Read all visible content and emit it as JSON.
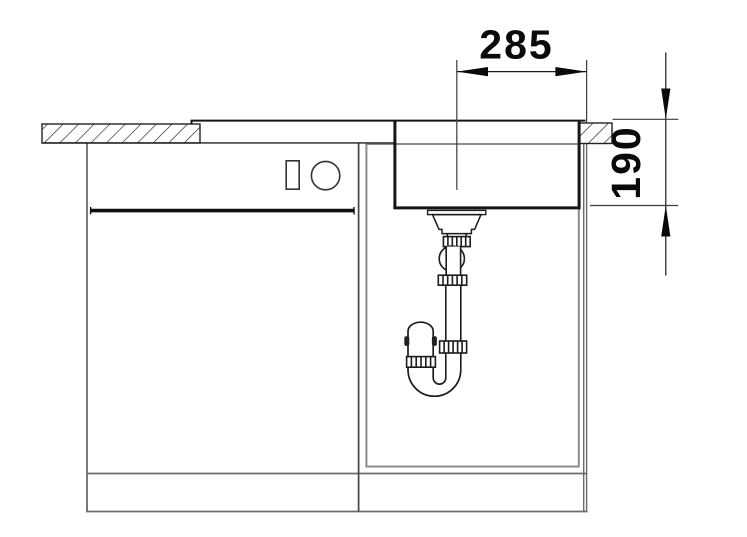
{
  "diagram": {
    "kind": "sink-installation-cross-section",
    "dimensions": {
      "width": {
        "value": "285"
      },
      "depth": {
        "value": "190"
      }
    },
    "colors": {
      "background": "#ffffff",
      "line_dark": "#1c1c1c",
      "line_cabinet": "#6b6b6b",
      "line_inner_box": "#8c8c8c",
      "line_divider": "#454545",
      "dimension_text": "#0a0a0a"
    }
  }
}
